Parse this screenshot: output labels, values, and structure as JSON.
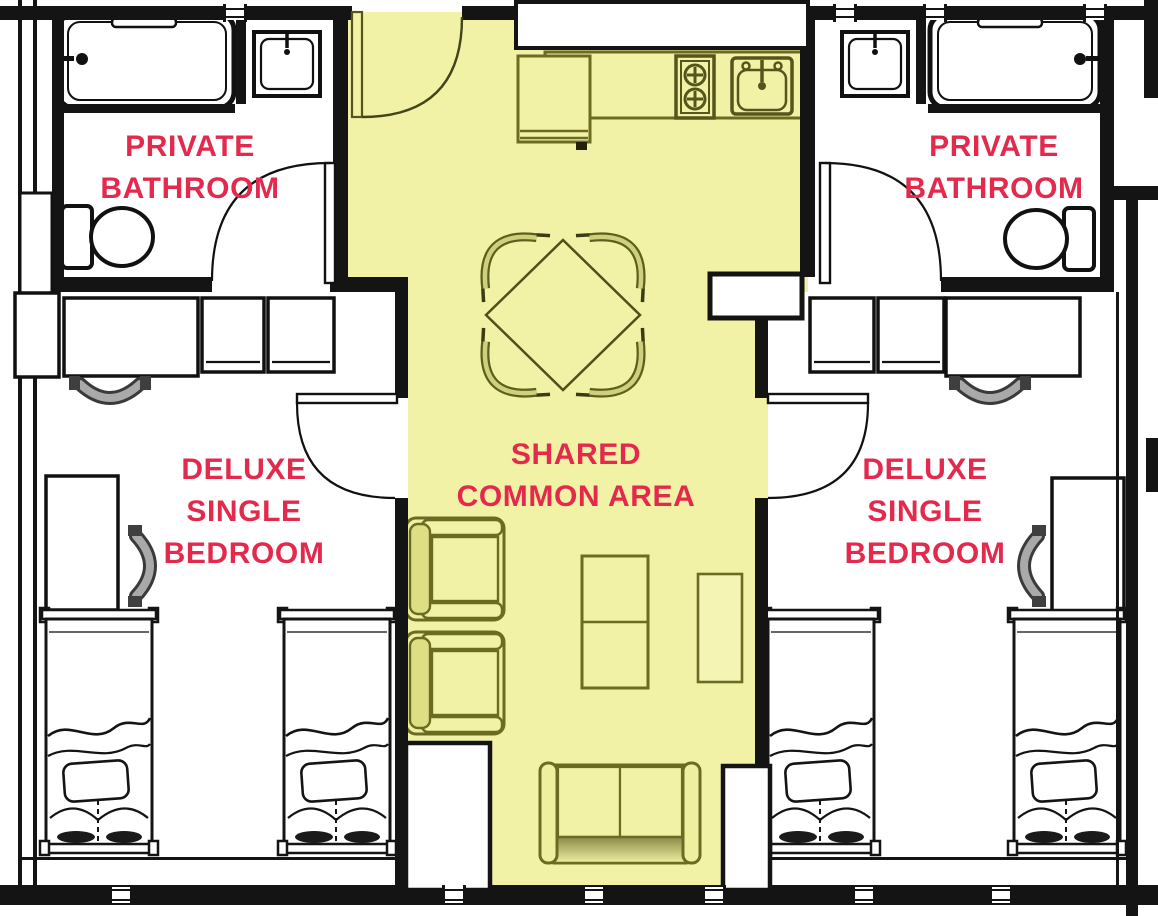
{
  "figure": {
    "type": "floor-plan",
    "subject": "Suite floor plan: two deluxe single bedrooms with private bathrooms around a shared common area"
  },
  "palette": {
    "wall_black": "#141414",
    "floor_white": "#ffffff",
    "common_area_fill": "#f1f2a6",
    "common_area_line": "#6b6b22",
    "label_red": "#e32a4d",
    "desk_chair_gray": "#a9a9a9"
  },
  "rooms": [
    {
      "id": "private-bathroom-left",
      "label_lines": [
        "PRIVATE",
        "BATHROOM"
      ],
      "furniture": [
        "bathtub",
        "sink",
        "toilet",
        "door"
      ]
    },
    {
      "id": "private-bathroom-right",
      "label_lines": [
        "PRIVATE",
        "BATHROOM"
      ],
      "furniture": [
        "sink",
        "bathtub",
        "toilet",
        "door"
      ]
    },
    {
      "id": "deluxe-single-bedroom-left",
      "label_lines": [
        "DELUXE",
        "SINGLE",
        "BEDROOM"
      ],
      "furniture": [
        "desk",
        "desk-chair",
        "wardrobe",
        "wardrobe",
        "side-desk",
        "side-desk-chair",
        "bed",
        "bed",
        "door"
      ]
    },
    {
      "id": "deluxe-single-bedroom-right",
      "label_lines": [
        "DELUXE",
        "SINGLE",
        "BEDROOM"
      ],
      "furniture": [
        "wardrobe",
        "wardrobe",
        "desk",
        "desk-chair",
        "side-desk",
        "side-desk-chair",
        "bed",
        "bed",
        "door"
      ]
    },
    {
      "id": "shared-common-area",
      "label_lines": [
        "SHARED",
        "COMMON AREA"
      ],
      "furniture": [
        "entry-door",
        "refrigerator",
        "stove",
        "kitchen-sink",
        "kitchen-counter",
        "dining-table",
        "dining-chair",
        "dining-chair",
        "dining-chair",
        "dining-chair",
        "armchair",
        "armchair",
        "coffee-table",
        "side-table",
        "sofa",
        "closet",
        "closet",
        "shelf"
      ]
    }
  ]
}
